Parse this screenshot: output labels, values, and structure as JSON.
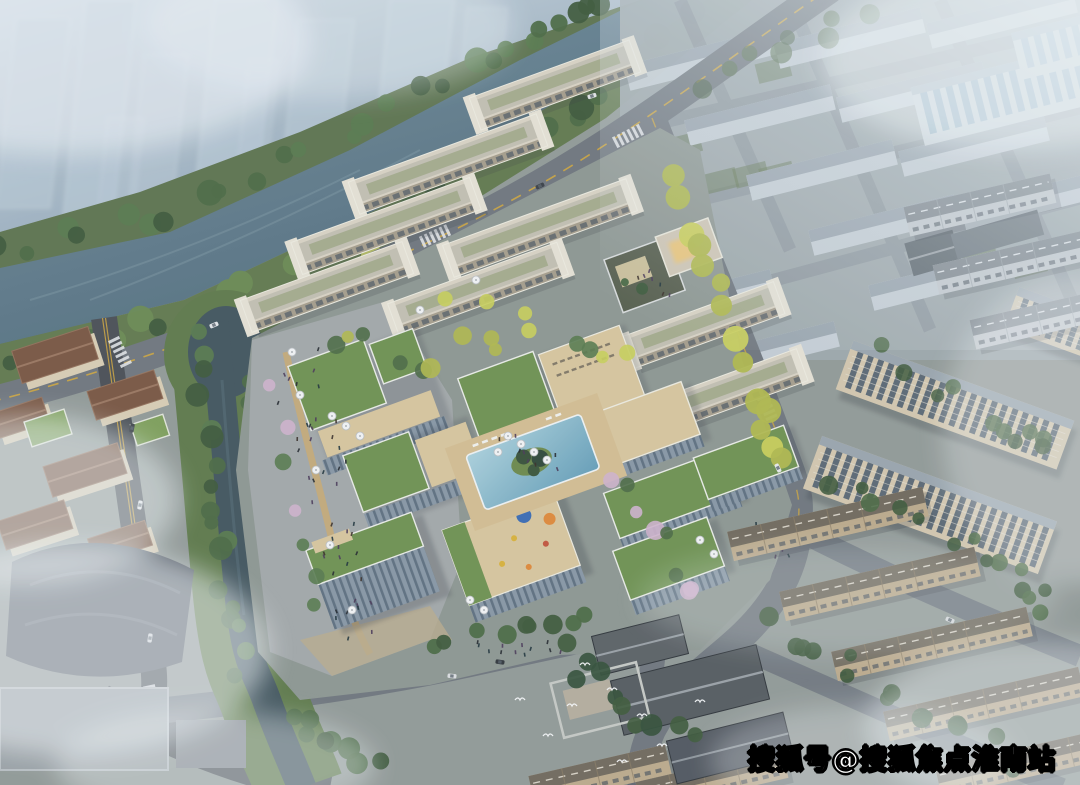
{
  "watermark": {
    "text": "搜狐号@搜狐焦点淮南站",
    "color": "#ffffff",
    "outline": "#000000"
  },
  "scene": {
    "type": "aerial-architectural-rendering",
    "regions": [
      "misty-city-skyline",
      "river",
      "riverside-road",
      "tree-lined-canal",
      "pedestrian-plaza",
      "office-campus",
      "central-pool-courtyard",
      "entrance-gate",
      "residential-haze-district",
      "apartment-slabs",
      "townhouse-rows",
      "traditional-courtyard-complex",
      "villas",
      "fog"
    ]
  },
  "palette": {
    "ground": "#929a97",
    "sky1": "#c6d2dc",
    "sky2": "#90a5b5",
    "river1": "#6d8596",
    "river2": "#4f6a7a",
    "canal": "#43565e",
    "grass": "#5f7a4b",
    "treeG1": "#3f5a3c",
    "treeG2": "#4c6a45",
    "treeG3": "#587a4e",
    "treeY1": "#c9cf5a",
    "treeY2": "#b0b84e",
    "treeP": "#cfb3cc",
    "road": "#70777e",
    "roadDark": "#4b5056",
    "roadLight": "#8e979e",
    "laneYellow": "#cfa63f",
    "plaza": "#a3a8a9",
    "pathTan": "#c6aa76",
    "facade_cream": "#d8d2c3",
    "roofGreen": "#6f9252",
    "roofTan": "#d7c69e",
    "glass": "#8795a3",
    "poolLight": "#a7cdd9",
    "poolDeep": "#6aa3ba",
    "slabCream": "#d3c7ae",
    "winDark": "#47586a",
    "townWall": "#bcaa8c",
    "townRoof": "#716a5d",
    "hazeBody": "#c8d0d7",
    "hazeRoof": "#9aa5ae",
    "tradRoof": "#565c60",
    "villaRoof": "#7a5743",
    "fog": "#eef3f6"
  }
}
